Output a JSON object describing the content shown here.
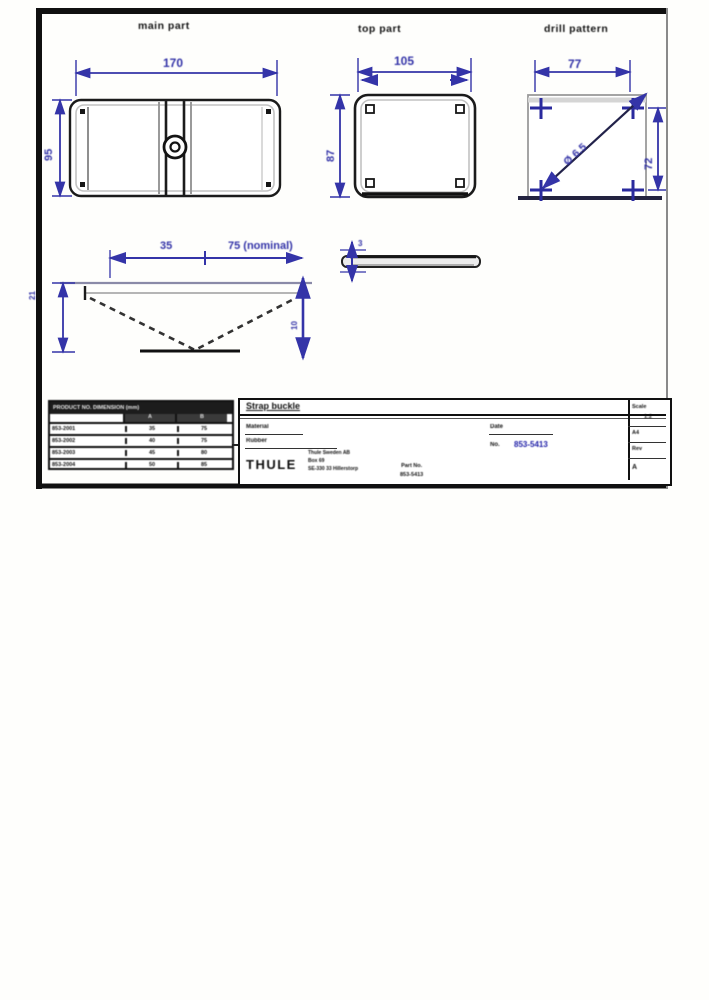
{
  "colors": {
    "dimension_blue": "#3434a8",
    "line_black": "#1b1b1b",
    "line_gray": "#9a9a9a",
    "drawing_no_blue": "#1d1da6"
  },
  "labels": {
    "view1": "main part",
    "view2": "top part",
    "view3": "drill pattern"
  },
  "dims": {
    "view1_width": "170",
    "view1_height": "95",
    "view2_width": "105",
    "view2_height": "87",
    "view3_width": "77",
    "view3_height": "72",
    "view3_hole": "Ø 6.5",
    "profile_a": "35",
    "profile_b": "75 (nominal)",
    "profile_height": "21",
    "profile_drop": "10",
    "strap_thickness": "3"
  },
  "parts_table": {
    "header": "PRODUCT NO.  DIMENSION (mm)",
    "sub_a": "A",
    "sub_b": "B",
    "rows": [
      {
        "name": "853-2001",
        "a": "35",
        "b": "75"
      },
      {
        "name": "853-2002",
        "a": "40",
        "b": "75"
      },
      {
        "name": "853-2003",
        "a": "45",
        "b": "80"
      },
      {
        "name": "853-2004",
        "a": "50",
        "b": "85"
      }
    ]
  },
  "title_block": {
    "title": "Strap buckle",
    "material_label": "Material",
    "material_value": "Rubber",
    "date_label": "Date",
    "no_label": "No.",
    "drawing_no": "853-5413",
    "logo": "THULE",
    "address": "Thule Sweden AB\nBox 69\nSE-330 33 Hillerstorp",
    "part_block": "Part No.\n853-5413",
    "scale_label": "Scale",
    "scale_value": "1:2",
    "format": "A4",
    "rev_label": "Rev",
    "rev_value": "A"
  }
}
